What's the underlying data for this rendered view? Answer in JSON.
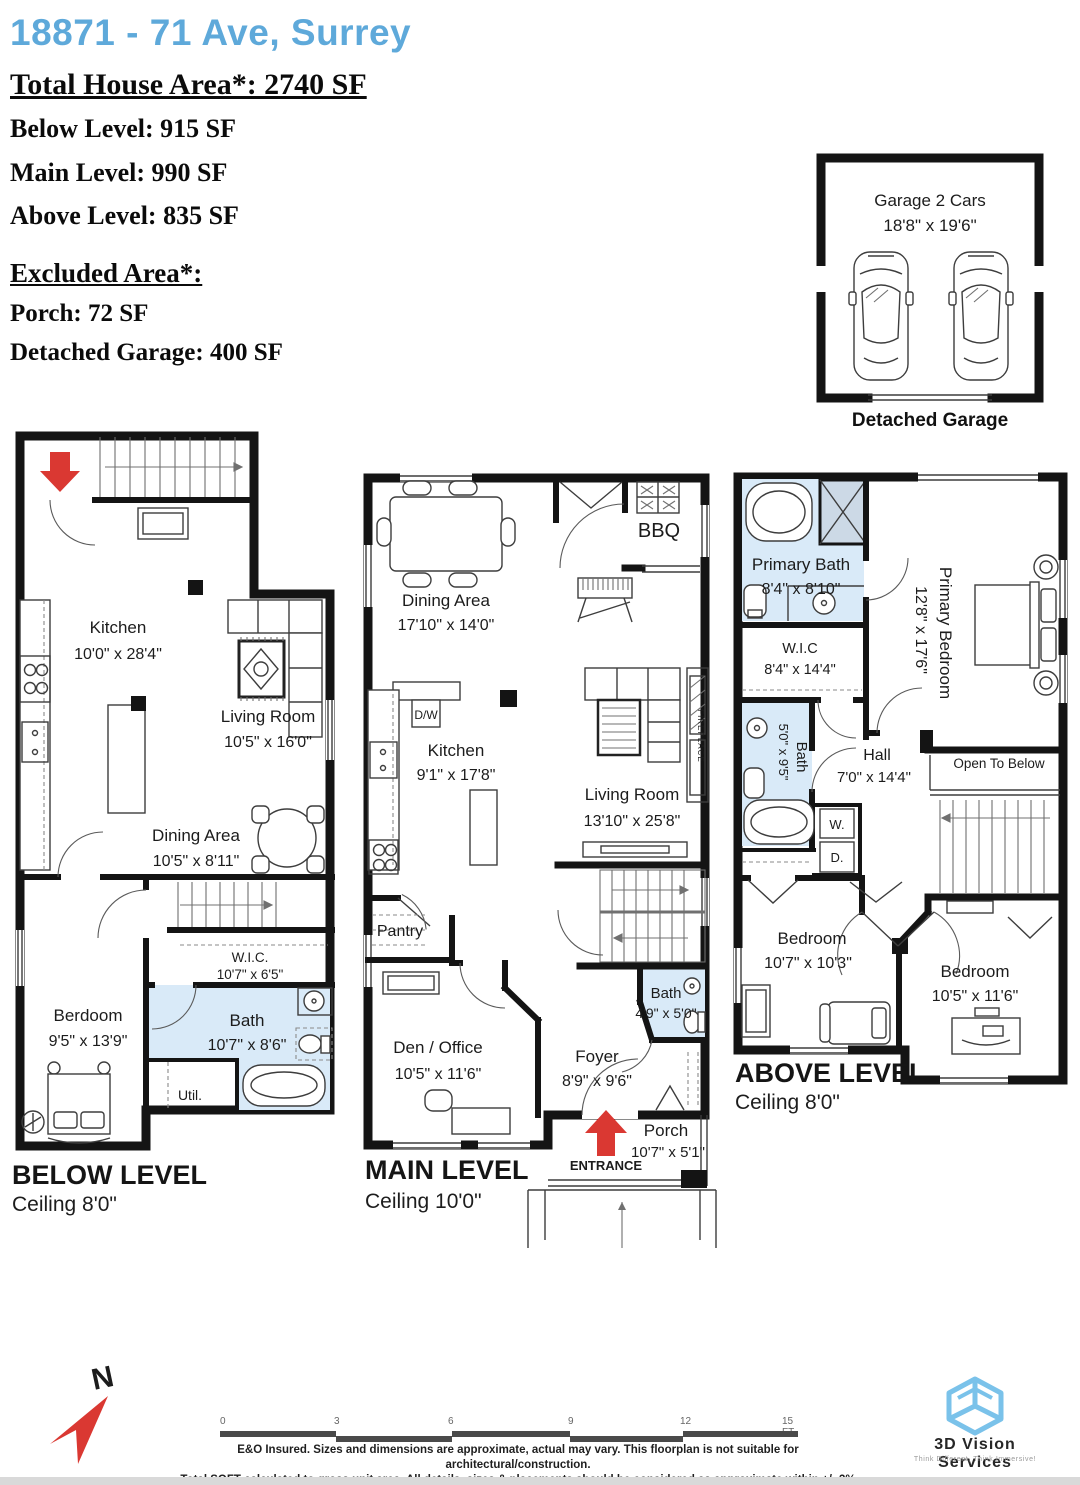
{
  "header": {
    "address": "18871 - 71 Ave, Surrey",
    "total": "Total House Area*: 2740 SF",
    "below": "Below Level: 915 SF",
    "main": "Main Level: 990 SF",
    "above": "Above Level: 835 SF",
    "excluded_title": "Excluded Area*:",
    "porch": "Porch: 72 SF",
    "detached_garage": "Detached Garage: 400 SF"
  },
  "garage": {
    "title": "Garage 2 Cars",
    "dims": "18'8\" x 19'6\"",
    "caption": "Detached Garage"
  },
  "below": {
    "title": "BELOW LEVEL",
    "ceiling": "Ceiling 8'0\"",
    "kitchen": {
      "name": "Kitchen",
      "dims": "10'0\" x 28'4\""
    },
    "living": {
      "name": "Living Room",
      "dims": "10'5\" x 16'0\""
    },
    "dining": {
      "name": "Dining Area",
      "dims": "10'5\" x 8'11\""
    },
    "wic": {
      "name": "W.I.C.",
      "dims": "10'7\" x 6'5\""
    },
    "bedroom": {
      "name": "Berdoom",
      "dims": "9'5\" x 13'9\""
    },
    "bath": {
      "name": "Bath",
      "dims": "10'7\" x 8'6\""
    },
    "util": {
      "name": "Util."
    }
  },
  "main": {
    "title": "MAIN LEVEL",
    "ceiling": "Ceiling 10'0\"",
    "dining": {
      "name": "Dining Area",
      "dims": "17'10\" x 14'0\""
    },
    "bbq": {
      "name": "BBQ"
    },
    "dw": {
      "name": "D/W"
    },
    "kitchen": {
      "name": "Kitchen",
      "dims": "9'1\" x 17'8\""
    },
    "living": {
      "name": "Living Room",
      "dims": "13'10\" x 25'8\""
    },
    "fireplace": {
      "name": "FIREPLACE"
    },
    "pantry": {
      "name": "Pantry"
    },
    "den": {
      "name": "Den / Office",
      "dims": "10'5\" x 11'6\""
    },
    "bath": {
      "name": "Bath",
      "dims": "4'9\" x 5'0\""
    },
    "foyer": {
      "name": "Foyer",
      "dims": "8'9\" x 9'6\""
    },
    "porch": {
      "name": "Porch",
      "dims": "10'7\" x 5'1\""
    },
    "entrance": {
      "name": "ENTRANCE"
    }
  },
  "above": {
    "title": "ABOVE LEVEL",
    "ceiling": "Ceiling 8'0\"",
    "primary_bath": {
      "name": "Primary Bath",
      "dims": "8'4\" x 8'10\""
    },
    "wic": {
      "name": "W.I.C",
      "dims": "8'4\" x 14'4\""
    },
    "primary_bedroom": {
      "name": "Primary Bedroom",
      "dims": "12'8\" x 17'6\""
    },
    "bath": {
      "name": "Bath",
      "dims": "5'0\" x 9'5\""
    },
    "hall": {
      "name": "Hall",
      "dims": "7'0\" x 14'4\""
    },
    "washer": {
      "name": "W."
    },
    "dryer": {
      "name": "D."
    },
    "open_below": {
      "name": "Open To Below"
    },
    "bedroom1": {
      "name": "Bedroom",
      "dims": "10'7\" x 10'3\""
    },
    "bedroom2": {
      "name": "Bedroom",
      "dims": "10'5\" x 11'6\""
    }
  },
  "footer": {
    "north": "N",
    "scale": [
      "0",
      "3",
      "6",
      "9",
      "12",
      "15 FT"
    ],
    "disclaimer_1": "E&O Insured. Sizes and dimensions are approximate, actual may vary. This floorplan is not suitable for architectural/construction.",
    "disclaimer_2": "Total SQFT calculated to gross unit area. All details, sizes & placements should be considered as approximate within +/- 3% tolerance.",
    "logo_name": "3D Vision Services",
    "logo_tagline": "Think Different, Think Immersive!"
  },
  "colors": {
    "address_blue": "#5ea9da",
    "bath_fill": "#d9eaf8",
    "shower_fill": "#ccd9e6",
    "wall": "#141414",
    "entrance_red": "#da3832",
    "logo_blue": "#7ac2ea",
    "scale_gray": "#4a4a4a"
  }
}
